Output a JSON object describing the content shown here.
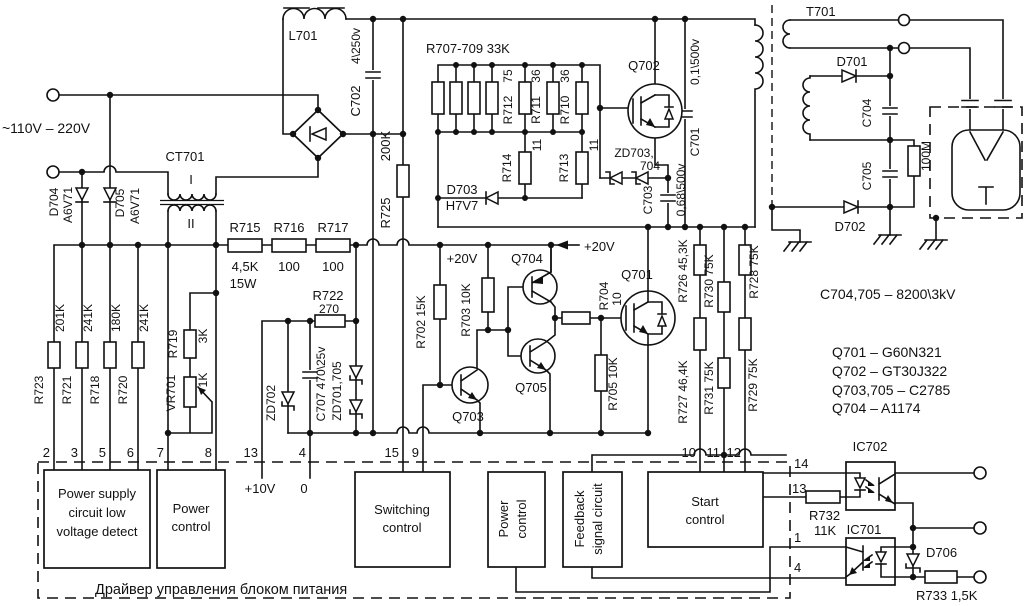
{
  "title": "Power supply driver schematic",
  "colors": {
    "ink": "#111111",
    "background": "#ffffff"
  },
  "t": {
    "vin": "~110V – 220V",
    "l701": "L701",
    "c702": "C702",
    "c702v": "4\\250v",
    "d704": "D704",
    "d704v": "A6V71",
    "d705": "D705",
    "d705v": "A6V71",
    "ct701": "CT701",
    "w1": "I",
    "w2": "II",
    "r723": "R723",
    "r723v": "201K",
    "r721": "R721",
    "r721v": "241K",
    "r718": "R718",
    "r718v": "180K",
    "r720": "R720",
    "r720v": "241K",
    "r719": "R719",
    "r719v": "3K",
    "vr701": "VR701",
    "vr701v": "1K",
    "r715": "R715",
    "r715v1": "4,5K",
    "r715v2": "15W",
    "r716": "R716",
    "r716v": "100",
    "r717": "R717",
    "r717v": "100",
    "r722": "R722",
    "r722v": "270",
    "zd702": "ZD702",
    "c707": "C707 470\\25v",
    "zd701705": "ZD701,705",
    "r725": "R725",
    "r725v": "200K",
    "rnet": "R707-709  33K",
    "r712": "R712",
    "r712v": "75",
    "r711": "R711",
    "r711v": "36",
    "r710": "R710",
    "r710v": "36",
    "r714": "R714",
    "r714v": "11",
    "r713": "R713",
    "r713v": "11",
    "d703": "D703",
    "d703v": "H7V7",
    "q702": "Q702",
    "zd703a": "ZD703,",
    "zd703b": "704",
    "c703": "C703",
    "c703v": "0,68\\500v",
    "c701": "C701",
    "c701v": "0,1\\500v",
    "p20v": "+20V",
    "r702": "R702 15K",
    "r703": "R703 10K",
    "q703": "Q703",
    "q704": "Q704",
    "q705": "Q705",
    "r704": "R704",
    "r704v": "10",
    "r705": "R705 10K",
    "q701": "Q701",
    "r726": "R726 45,3K",
    "r727": "R727 46,4K",
    "r730": "R730 75K",
    "r731": "R731 75K",
    "r728": "R728 75K",
    "r729": "R729 75K",
    "t701": "T701",
    "d701": "D701",
    "c704": "C704",
    "c705": "C705",
    "r100m": "100M",
    "d702": "D702",
    "note1": "C704,705 – 8200\\3kV",
    "q701p": "Q701 – G60N321",
    "q702p": "Q702 – GT30J322",
    "q703p": "Q703,705 – C2785",
    "q704p": "Q704 – A1174",
    "p2": "2",
    "p3": "3",
    "p5": "5",
    "p6": "6",
    "p7": "7",
    "p8": "8",
    "p13": "13",
    "p4": "4",
    "p15": "15",
    "p9": "9",
    "p10": "10",
    "p11": "11",
    "p12": "12",
    "p14": "14",
    "p13b": "13",
    "p1": "1",
    "p4b": "4",
    "p10v": "+10V",
    "p0": "0",
    "b1l1": "Power supply",
    "b1l2": "circuit low",
    "b1l3": "voltage detect",
    "b2l1": "Power",
    "b2l2": "control",
    "b3l1": "Switching",
    "b3l2": "control",
    "b4l1": "Power",
    "b4l2": "control",
    "b5l1": "Feedback",
    "b5l2": "signal circuit",
    "b6l1": "Start",
    "b6l2": "control",
    "ic702": "IC702",
    "ic701": "IC701",
    "r732": "R732",
    "r732v": "11K",
    "d706": "D706",
    "r733": "R733 1,5K",
    "caption": "Драйвер управления блоком питания"
  }
}
